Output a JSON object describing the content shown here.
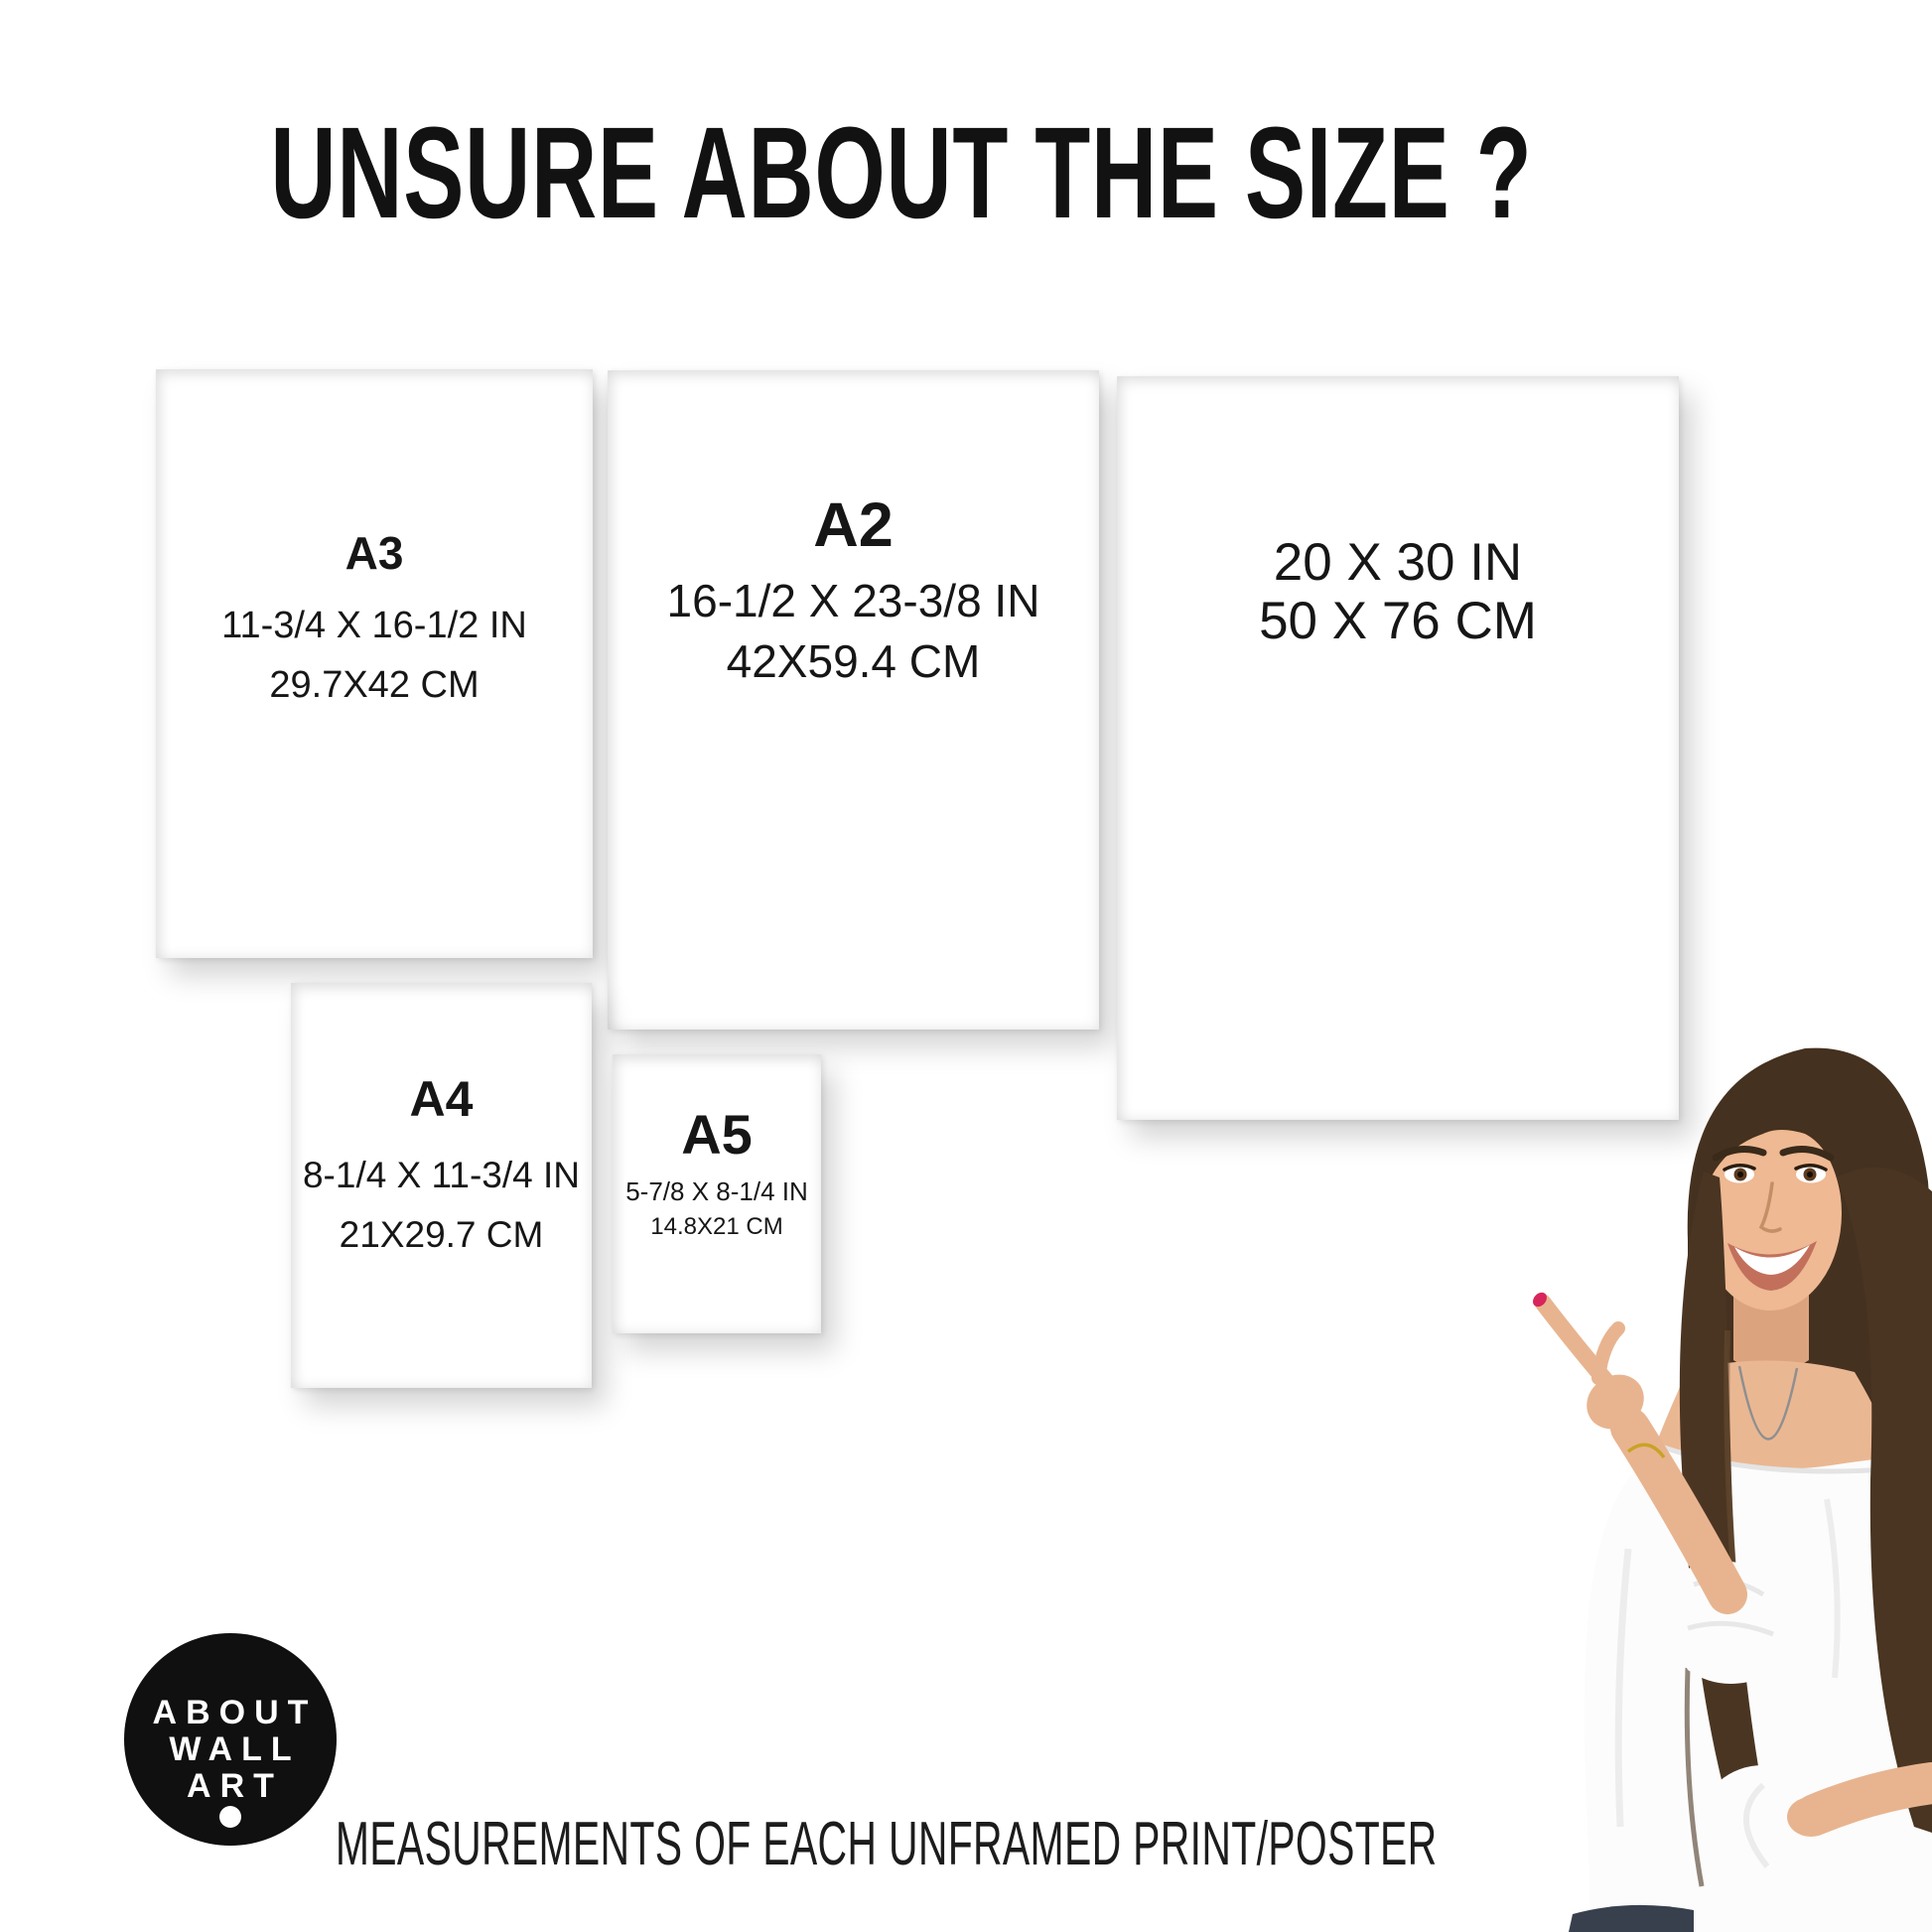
{
  "page": {
    "title": "UNSURE ABOUT THE SIZE ?",
    "footer_note": "MEASUREMENTS OF EACH UNFRAMED PRINT/POSTER",
    "background_color": "#ffffff",
    "text_color": "#161616",
    "frame_color": "#161616"
  },
  "frames": [
    {
      "label": "A3",
      "inches": "11-3/4 X 16-1/2 IN",
      "cm": "29.7X42 CM"
    },
    {
      "label": "A2",
      "inches": "16-1/2 X 23-3/8 IN",
      "cm": "42X59.4 CM"
    },
    {
      "label": "",
      "inches": "20 X 30 IN",
      "cm": "50 X 76 CM"
    },
    {
      "label": "A4",
      "inches": "8-1/4 X 11-3/4 IN",
      "cm": "21X29.7 CM"
    },
    {
      "label": "A5",
      "inches": "5-7/8 X 8-1/4 IN",
      "cm": "14.8X21 CM"
    }
  ],
  "logo": {
    "line1": "ABOUT",
    "line2": "WALL",
    "line3": "ART",
    "background_color": "#101010",
    "text_color": "#ffffff"
  },
  "photo": {
    "subject": "smiling woman with long brown hair pointing left at the frames",
    "hair_color": "#45311f",
    "skin_color": "#eab793",
    "blouse_color": "#fcfcfc",
    "nail_color": "#d8255c",
    "jeans_color": "#39404d"
  }
}
